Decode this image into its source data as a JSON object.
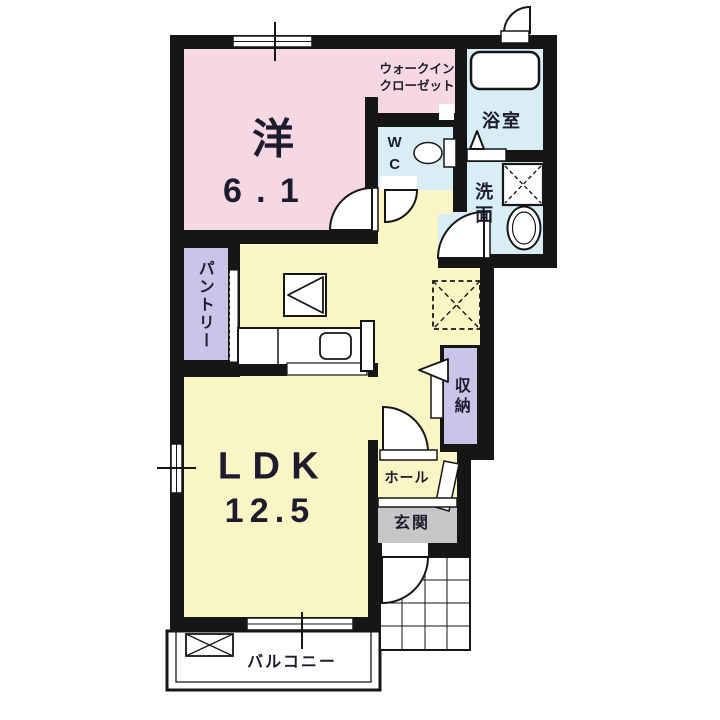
{
  "floorplan": {
    "rooms": {
      "bedroom": {
        "name_label": "洋",
        "size_label": "6.1"
      },
      "walk_in_closet": {
        "label": "ウォークイン\nクローゼット"
      },
      "toilet": {
        "label": "WC"
      },
      "bathroom": {
        "label": "浴室"
      },
      "washroom": {
        "label": "洗面"
      },
      "ldk": {
        "name_label": "LDK",
        "size_label": "12.5"
      },
      "pantry": {
        "label": "パントリー"
      },
      "storage": {
        "label": "収納"
      },
      "hall": {
        "label": "ホール"
      },
      "entrance": {
        "label": "玄関"
      },
      "balcony": {
        "label": "バルコニー"
      }
    },
    "colors": {
      "wall": "#161616",
      "bedroom_fill": "#f6d8e2",
      "living_fill": "#faf5c5",
      "wet_area_fill": "#d8edf4",
      "closet_fill": "#c9c5e9",
      "entrance_fill": "#c6c6c6",
      "background": "#ffffff"
    },
    "symbols": [
      "bathtub",
      "toilet",
      "washbasin",
      "washing-machine-pan",
      "refrigerator-space",
      "kitchen-counter-with-sink",
      "sliding-window",
      "door-swing-arc",
      "folding-bath-door",
      "entrance-porch-tiles",
      "balcony-drain-box"
    ]
  }
}
